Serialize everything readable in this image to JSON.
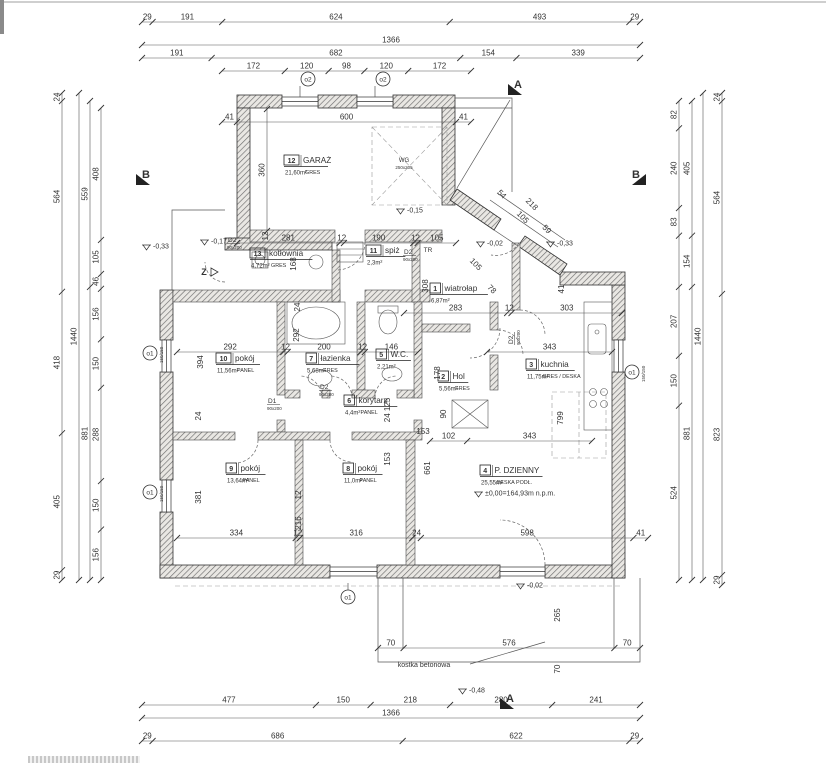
{
  "plan": {
    "rooms": [
      {
        "no": "12",
        "name": "GARAŻ",
        "area": "21,60m²",
        "floor": "GRES",
        "x": 284,
        "y": 163
      },
      {
        "no": "13",
        "name": "kotłownia",
        "area": "4,72m²",
        "floor": "GRES",
        "x": 250,
        "y": 256
      },
      {
        "no": "11",
        "name": "spiż",
        "area": "2,3m²",
        "floor": "",
        "x": 366,
        "y": 253
      },
      {
        "no": "1",
        "name": "wiatrołap",
        "area": "6,87m²",
        "floor": "",
        "x": 430,
        "y": 291
      },
      {
        "no": "10",
        "name": "pokój",
        "area": "11,56m²",
        "floor": "PANEL",
        "x": 216,
        "y": 361
      },
      {
        "no": "7",
        "name": "łazienka",
        "area": "5,68m²",
        "floor": "GRES",
        "x": 306,
        "y": 361
      },
      {
        "no": "5",
        "name": "W.C.",
        "area": "2,21m²",
        "floor": "",
        "x": 376,
        "y": 357
      },
      {
        "no": "6",
        "name": "korytarz",
        "area": "4,4m²",
        "floor": "PANEL",
        "x": 344,
        "y": 403
      },
      {
        "no": "2",
        "name": "Hol",
        "area": "5,56m²",
        "floor": "GRES",
        "x": 438,
        "y": 379
      },
      {
        "no": "3",
        "name": "kuchnia",
        "area": "11,75m²",
        "floor": "GRES / DESKA",
        "x": 526,
        "y": 367
      },
      {
        "no": "9",
        "name": "pokój",
        "area": "13,64m²",
        "floor": "PANEL",
        "x": 226,
        "y": 471
      },
      {
        "no": "8",
        "name": "pokój",
        "area": "11,0m²",
        "floor": "PANEL",
        "x": 343,
        "y": 471
      },
      {
        "no": "4",
        "name": "P. DZIENNY",
        "area": "25,55m²",
        "floor": "DESKA PODŁ.",
        "x": 480,
        "y": 473
      }
    ],
    "dim_chains": [
      {
        "o": "h",
        "c": 22,
        "a": 142,
        "b": 640,
        "s": [
          29,
          191,
          624,
          493,
          29
        ]
      },
      {
        "o": "h",
        "c": 45,
        "a": 142,
        "b": 640,
        "s": [
          1366
        ]
      },
      {
        "o": "h",
        "c": 58,
        "a": 142,
        "b": 640,
        "s": [
          191,
          682,
          154,
          339
        ]
      },
      {
        "o": "h",
        "c": 71,
        "a": 222,
        "b": 471,
        "s": [
          172,
          120,
          98,
          120,
          172
        ]
      },
      {
        "o": "h",
        "c": 705,
        "a": 142,
        "b": 640,
        "s": [
          477,
          150,
          218,
          280,
          241
        ]
      },
      {
        "o": "h",
        "c": 718,
        "a": 142,
        "b": 640,
        "s": [
          1366
        ]
      },
      {
        "o": "h",
        "c": 741,
        "a": 142,
        "b": 640,
        "s": [
          29,
          686,
          622,
          29
        ]
      },
      {
        "o": "v",
        "c": 62,
        "a": 93,
        "b": 580,
        "s": [
          24,
          564,
          418,
          405,
          29
        ]
      },
      {
        "o": "v",
        "c": 79,
        "a": 93,
        "b": 580,
        "s": [
          1440
        ]
      },
      {
        "o": "v",
        "c": 90,
        "a": 101,
        "b": 580,
        "s": [
          559,
          881
        ]
      },
      {
        "o": "v",
        "c": 101,
        "a": 108,
        "b": 580,
        "s": [
          408,
          105,
          46,
          156,
          150,
          288,
          150,
          156
        ]
      },
      {
        "o": "v",
        "c": 679,
        "a": 101,
        "b": 580,
        "s": [
          82,
          240,
          83,
          {
            "v": 154,
            "t": ""
          },
          207,
          150,
          524
        ]
      },
      {
        "o": "v",
        "c": 692,
        "a": 101,
        "b": 580,
        "s": [
          405,
          154,
          881
        ]
      },
      {
        "o": "v",
        "c": 703,
        "a": 93,
        "b": 580,
        "s": [
          1440
        ]
      },
      {
        "o": "v",
        "c": 722,
        "a": 93,
        "b": 585,
        "s": [
          24,
          564,
          823,
          29
        ]
      },
      {
        "o": "h",
        "c": 122,
        "a": 222,
        "b": 471,
        "s": [
          41,
          600,
          41
        ]
      },
      {
        "o": "h",
        "c": 243,
        "a": 237,
        "b": 456,
        "s": [
          281,
          12,
          190,
          12,
          105
        ]
      },
      {
        "o": "h",
        "c": 352,
        "a": 177,
        "b": 418,
        "s": [
          292,
          12,
          200,
          12,
          146
        ]
      },
      {
        "o": "h",
        "c": 313,
        "a": 404,
        "b": 622,
        "s": [
          283,
          12,
          303
        ]
      },
      {
        "o": "h",
        "c": 352,
        "a": 487,
        "b": 612,
        "s": [
          343
        ]
      },
      {
        "o": "h",
        "c": 441,
        "a": 430,
        "b": 592,
        "s": [
          102,
          343
        ]
      },
      {
        "o": "h",
        "c": 538,
        "a": 177,
        "b": 648,
        "s": [
          334,
          12,
          316,
          24,
          598,
          41
        ]
      },
      {
        "o": "h",
        "c": 648,
        "a": 378,
        "b": 640,
        "s": [
          70,
          576,
          70
        ]
      },
      {
        "o": "v",
        "c": 267,
        "a": 109,
        "b": 231,
        "s": [
          360
        ]
      }
    ],
    "free_labels": [
      {
        "t": "12",
        "x": 268,
        "y": 236,
        "r": -90
      },
      {
        "t": "168",
        "x": 296,
        "y": 264,
        "r": -90
      },
      {
        "t": "308",
        "x": 428,
        "y": 286,
        "r": -90
      },
      {
        "t": "24",
        "x": 300,
        "y": 307,
        "r": -90
      },
      {
        "t": "292",
        "x": 299,
        "y": 335,
        "r": -90
      },
      {
        "t": "394",
        "x": 203,
        "y": 362,
        "r": -90
      },
      {
        "t": "24",
        "x": 201,
        "y": 416,
        "r": -90
      },
      {
        "t": "381",
        "x": 201,
        "y": 497,
        "r": -90
      },
      {
        "t": "24 125",
        "x": 390,
        "y": 410,
        "r": -90
      },
      {
        "t": "153",
        "x": 390,
        "y": 459,
        "r": -90
      },
      {
        "t": "12",
        "x": 301,
        "y": 495,
        "r": -90
      },
      {
        "t": "216",
        "x": 301,
        "y": 523,
        "r": -90
      },
      {
        "t": "661",
        "x": 430,
        "y": 468,
        "r": -90
      },
      {
        "t": "90",
        "x": 446,
        "y": 414,
        "r": -90
      },
      {
        "t": "178",
        "x": 440,
        "y": 373,
        "r": -90
      },
      {
        "t": "799",
        "x": 563,
        "y": 418,
        "r": -90
      },
      {
        "t": "41",
        "x": 564,
        "y": 289,
        "r": -90
      },
      {
        "t": "265",
        "x": 560,
        "y": 615,
        "r": -90
      },
      {
        "t": "70",
        "x": 560,
        "y": 669,
        "r": -90
      },
      {
        "t": "153",
        "x": 423,
        "y": 434,
        "r": 0
      },
      {
        "t": "54",
        "x": 500,
        "y": 196,
        "r": 45
      },
      {
        "t": "218",
        "x": 530,
        "y": 206,
        "r": 45
      },
      {
        "t": "105",
        "x": 521,
        "y": 219,
        "r": 45
      },
      {
        "t": "59",
        "x": 545,
        "y": 231,
        "r": 45
      },
      {
        "t": "105",
        "x": 474,
        "y": 266,
        "r": 45
      },
      {
        "t": "78",
        "x": 490,
        "y": 291,
        "r": 45
      },
      {
        "t": "WG",
        "x": 404,
        "y": 162,
        "r": 0,
        "fs": 6
      },
      {
        "t": "250x205",
        "x": 404,
        "y": 169,
        "r": 0,
        "fs": 4.5
      },
      {
        "t": "TR",
        "x": 428,
        "y": 252,
        "r": 0,
        "fs": 6.5
      },
      {
        "t": "kostka betonowa",
        "x": 424,
        "y": 667,
        "r": 0,
        "fs": 7
      }
    ],
    "levels": [
      {
        "t": "-0,15",
        "x": 396,
        "y": 207
      },
      {
        "t": "-0,17",
        "x": 200,
        "y": 238
      },
      {
        "t": "-0,33",
        "x": 142,
        "y": 243
      },
      {
        "t": "-0,02",
        "x": 476,
        "y": 240
      },
      {
        "t": "-0,33",
        "x": 546,
        "y": 240
      },
      {
        "t": "-0,02",
        "x": 516,
        "y": 582
      },
      {
        "t": "-0,48",
        "x": 458,
        "y": 687
      },
      {
        "t": "±0,00=164,93m n.p.m.",
        "x": 474,
        "y": 490
      }
    ],
    "section_markers": [
      {
        "t": "A",
        "x": 518,
        "y": 88,
        "d": 1
      },
      {
        "t": "A",
        "x": 510,
        "y": 702,
        "d": 1
      },
      {
        "t": "B",
        "x": 146,
        "y": 178,
        "d": 1
      },
      {
        "t": "B",
        "x": 636,
        "y": 178,
        "d": -1
      },
      {
        "t": "Z",
        "x": 204,
        "y": 275,
        "d": 1,
        "small": true
      }
    ],
    "window_tags": [
      {
        "t": "o2",
        "x": 308,
        "y": 79,
        "sub": ""
      },
      {
        "t": "o2",
        "x": 383,
        "y": 79,
        "sub": ""
      },
      {
        "t": "o1",
        "x": 150,
        "y": 353,
        "sub": "150/150"
      },
      {
        "t": "o1",
        "x": 150,
        "y": 492,
        "sub": "150/150"
      },
      {
        "t": "o1",
        "x": 632,
        "y": 372,
        "sub": "150/150"
      },
      {
        "t": "o1",
        "x": 348,
        "y": 597,
        "sub": ""
      }
    ],
    "door_tags": [
      {
        "l1": "D2",
        "l2": "90x200",
        "x": 228,
        "y": 242
      },
      {
        "l1": "D2",
        "l2": "90x200",
        "x": 404,
        "y": 254
      },
      {
        "l1": "D1",
        "l2": "90x200",
        "x": 268,
        "y": 403
      },
      {
        "l1": "D2",
        "l2": "90x200",
        "x": 320,
        "y": 389
      },
      {
        "l1": "D2",
        "l2": "90x200",
        "x": 513,
        "y": 344,
        "r": -90
      }
    ]
  }
}
